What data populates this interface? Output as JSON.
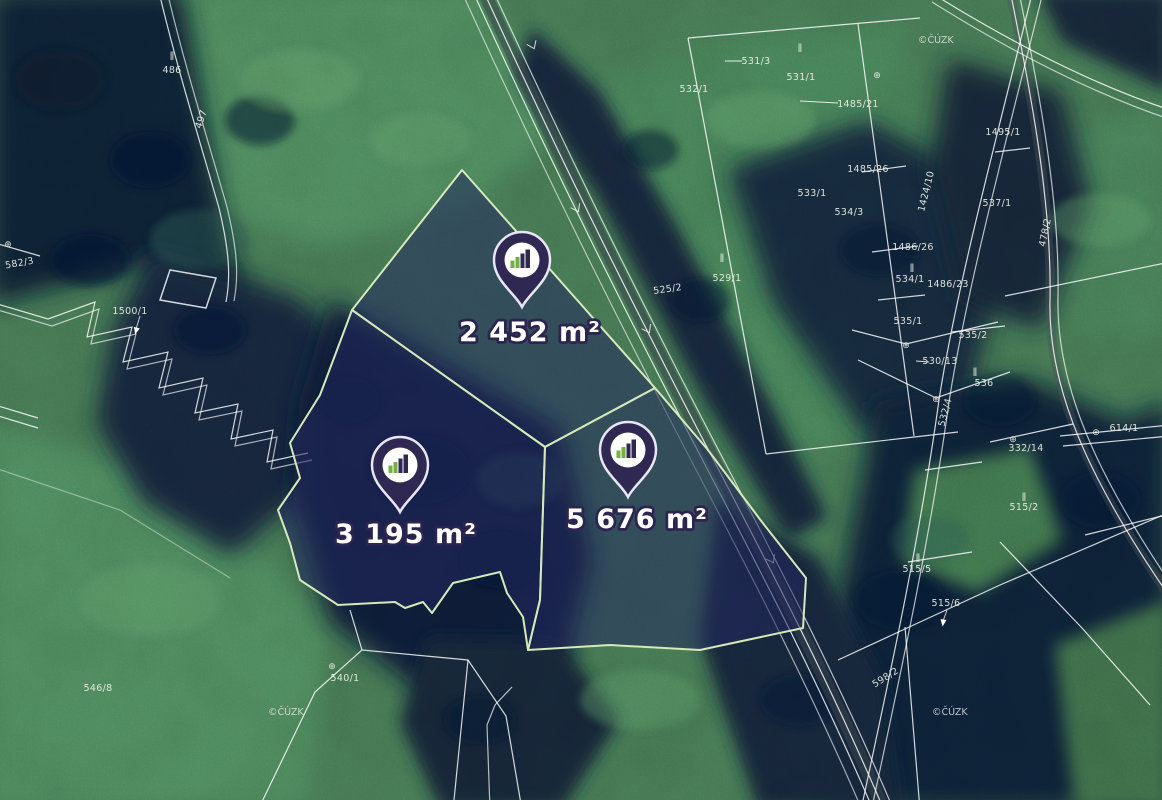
{
  "map": {
    "attribution": "©ČÚZK",
    "listings": [
      {
        "area_label": "2 452 m²"
      },
      {
        "area_label": "3 195 m²"
      },
      {
        "area_label": "5 676 m²"
      }
    ],
    "symbols": {
      "boundary_marker": "⊕",
      "grassland": "ǁ"
    },
    "colors": {
      "parcel_fill": "rgba(35,40,95,0.55)",
      "parcel_border": "#d6e9ba",
      "pin_fill": "#2e2852",
      "pin_ring": "#e8e6f4",
      "pin_logo_green": "#76b043",
      "area_label_text": "#ffffff",
      "area_label_outline": "#2b2550",
      "cadastral_line": "#ffffff",
      "cadastral_text": "#eef0e6",
      "meadow_green": "#4f8c5e",
      "forest_dark": "#101f38"
    },
    "cadastral_labels": [
      {
        "text": "486"
      },
      {
        "text": "497"
      },
      {
        "text": "531/3"
      },
      {
        "text": "532/1"
      },
      {
        "text": "531/1"
      },
      {
        "text": "1485/21"
      },
      {
        "text": "533/1"
      },
      {
        "text": "534/3"
      },
      {
        "text": "1485/26"
      },
      {
        "text": "1486/26"
      },
      {
        "text": "537/1"
      },
      {
        "text": "1424/10"
      },
      {
        "text": "534/1"
      },
      {
        "text": "1486/23"
      },
      {
        "text": "535/1"
      },
      {
        "text": "535/2"
      },
      {
        "text": "530/13"
      },
      {
        "text": "536"
      },
      {
        "text": "532/4"
      },
      {
        "text": "614/1"
      },
      {
        "text": "332/14"
      },
      {
        "text": "515/2"
      },
      {
        "text": "515/5"
      },
      {
        "text": "515/6"
      },
      {
        "text": "598/2"
      },
      {
        "text": "546/8"
      },
      {
        "text": "540/1"
      },
      {
        "text": "1500/1"
      },
      {
        "text": "582/3"
      },
      {
        "text": "525/2"
      },
      {
        "text": "529/1"
      },
      {
        "text": "1495/1"
      },
      {
        "text": "478/2"
      }
    ]
  }
}
